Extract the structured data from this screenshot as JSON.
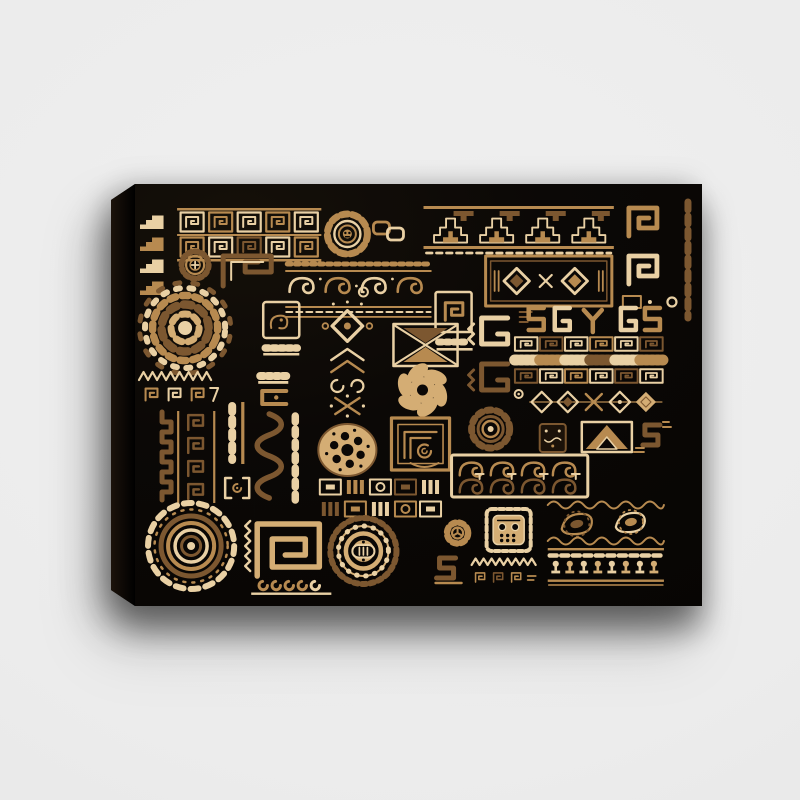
{
  "page": {
    "background_color": "#ececec"
  },
  "product": {
    "kind": "canvas wall art print",
    "orientation": "landscape",
    "canvas": {
      "face_color": "#0b0806",
      "side_color": "#1c130b",
      "shadow": "rgba(0,0,0,0.42)"
    },
    "artwork": {
      "style": "ethnic tribal handmade ornament collage, gold on black",
      "palette": {
        "ink": "#0b0806",
        "cream": "#e9d0a4",
        "light_gold": "#d4ad74",
        "gold": "#b78a50",
        "brown": "#7c5730",
        "dark_brown": "#55391a",
        "stamp_dark": "#1c1209"
      },
      "motifs": [
        "stair-glyphs",
        "greek-key-band",
        "sun-flower",
        "chain-links",
        "zigzag-pyramid-banner",
        "right-meander-strip",
        "cross-sun",
        "step-spiral-glyph",
        "wave-border-band",
        "spiral-stamp",
        "ornate-frame-panel",
        "dot-mandala",
        "stamp-and-comb",
        "ornate-column",
        "x-square",
        "pinwheel-flower",
        "g-spiral-glyphs",
        "glyph-letter-row",
        "tile-band",
        "ring-dots",
        "diamond-chain",
        "comb-yoke",
        "sawtooth-meander-band",
        "meander-panel",
        "loop-strip",
        "snake-squiggle-band",
        "dotted-wheel",
        "maze-square",
        "ray-sun",
        "dark-stamp",
        "triangle-frame",
        "s-bird-glyph",
        "scroll-banner",
        "paisley-band",
        "tribal-mask",
        "petal-wheel",
        "bracket-stamp",
        "tile-panel",
        "scallop-sun",
        "labyrinth-stamp",
        "gear-medallion",
        "s-glyph",
        "mini-zigzag-band",
        "goblet-frieze"
      ]
    }
  }
}
